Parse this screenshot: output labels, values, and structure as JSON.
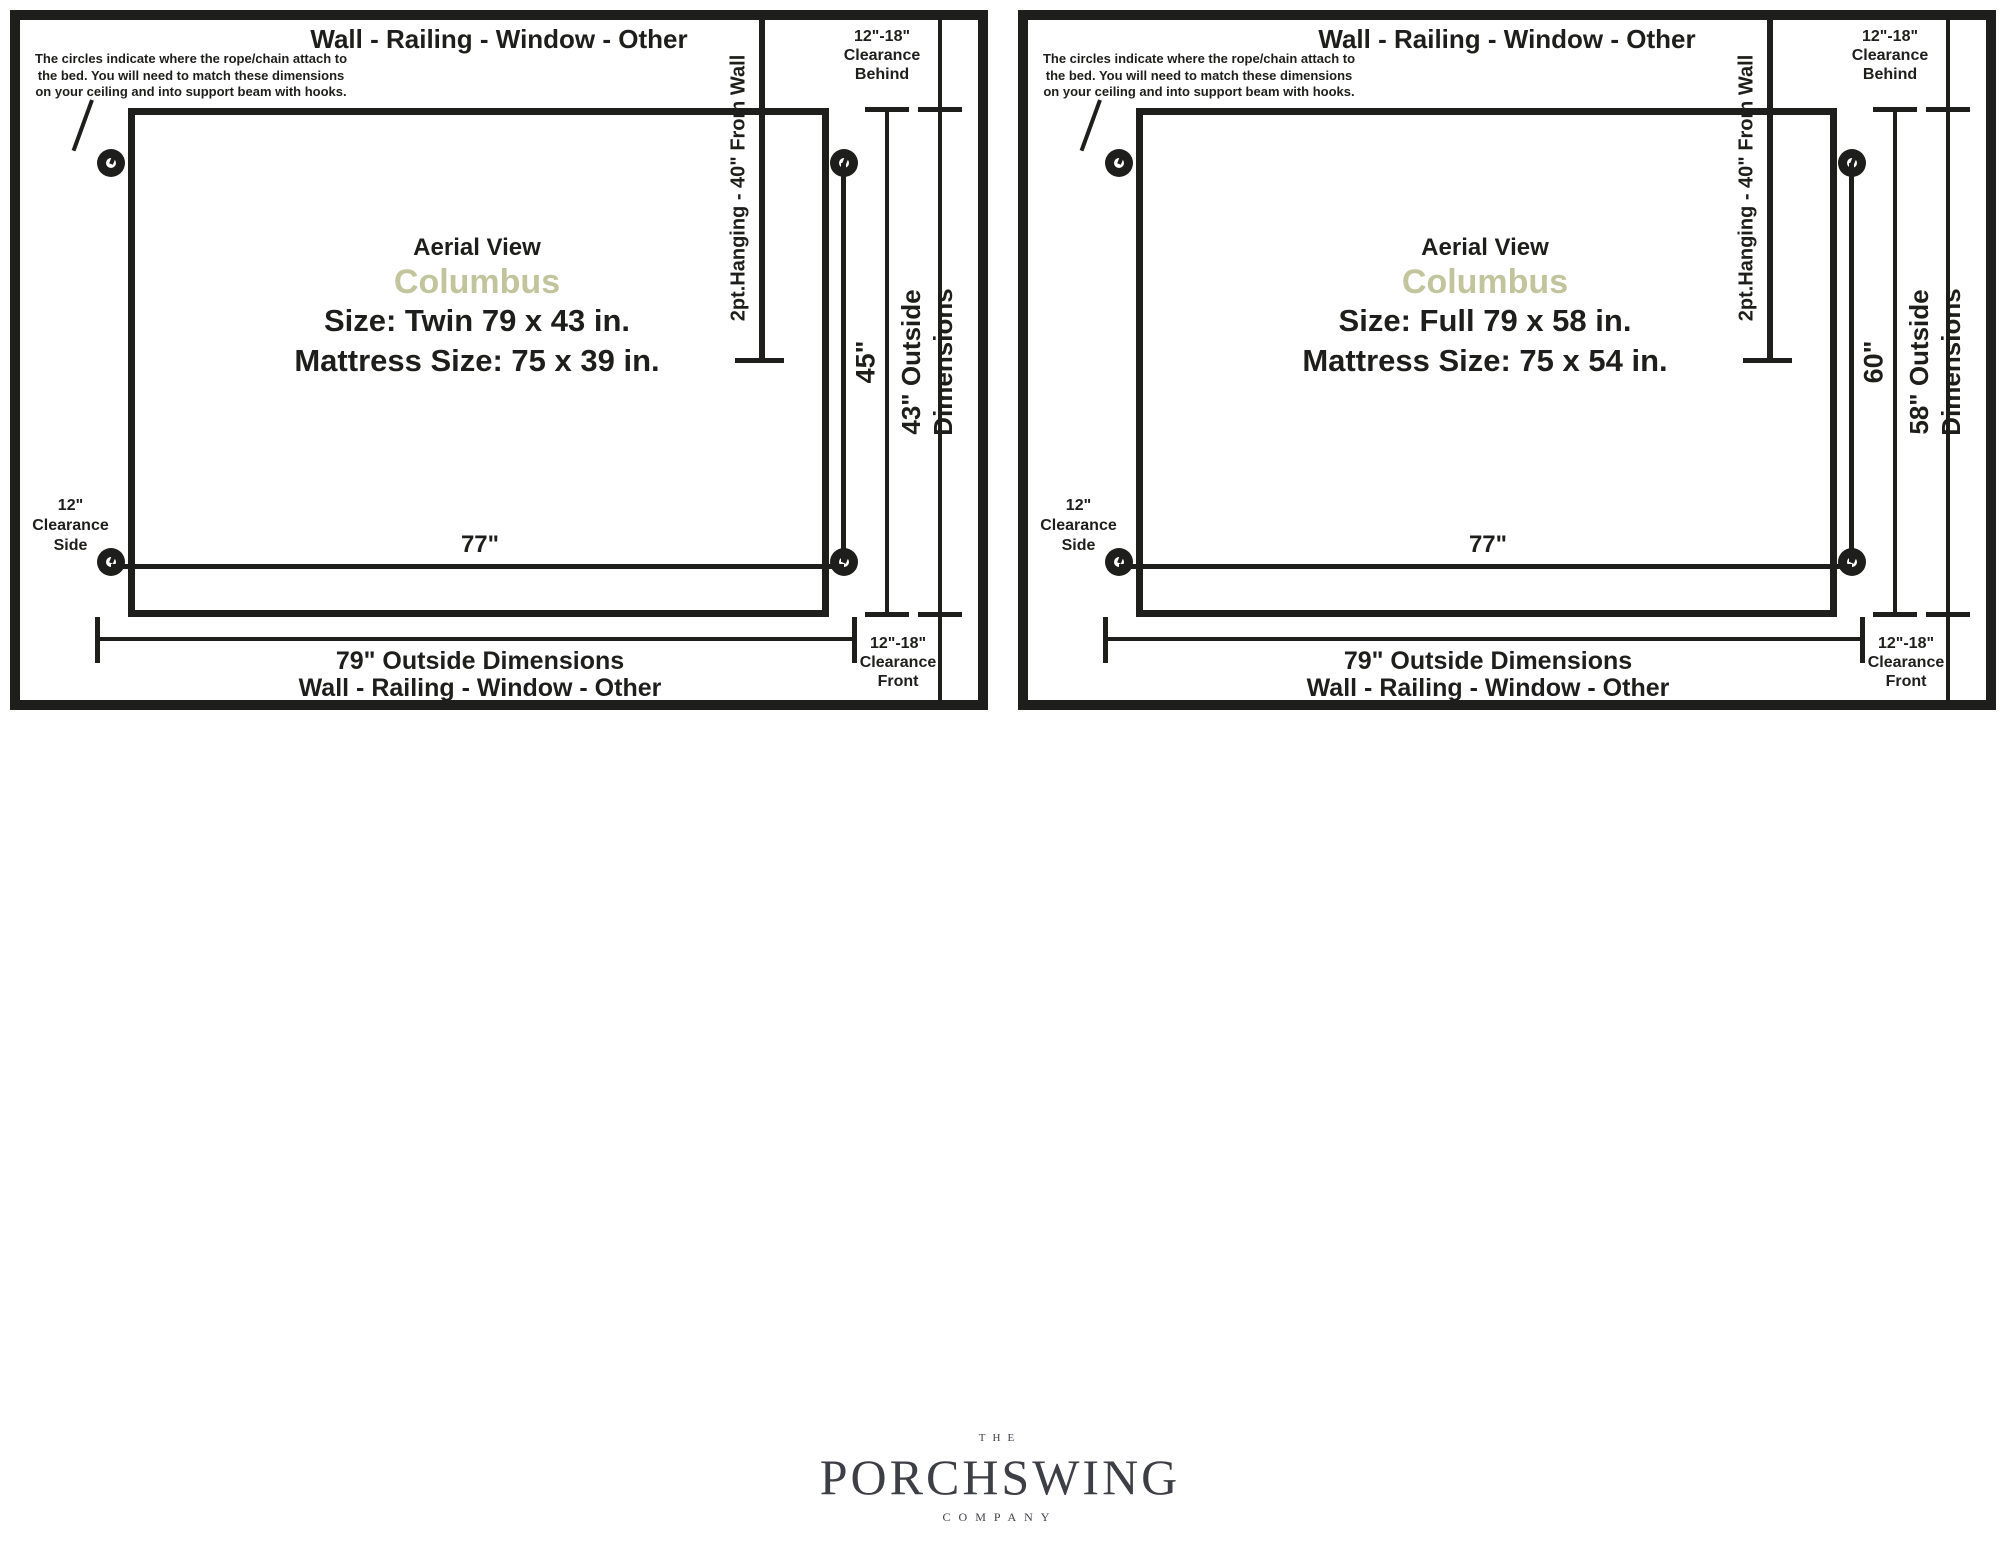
{
  "colors": {
    "ink": "#1e1e1c",
    "model_accent": "#c2c49c",
    "logo": "#3e3e46"
  },
  "diagrams": [
    {
      "top_label": "Wall - Railing - Window - Other",
      "note_lines": [
        "The circles indicate where the rope/chain attach to",
        "the bed. You will need to match these dimensions",
        "on your ceiling and into support beam with hooks."
      ],
      "hanging_label": "2pt.Hanging - 40\" From Wall",
      "clearance_behind": [
        "12\"-18\"",
        "Clearance",
        "Behind"
      ],
      "clearance_side": [
        "12\"",
        "Clearance",
        "Side"
      ],
      "clearance_front": [
        "12\"-18\"",
        "Clearance",
        "Front"
      ],
      "view_label": "Aerial View",
      "model_name": "Columbus",
      "size_line": "Size: Twin 79 x 43 in.",
      "mattress_line": "Mattress Size: 75 x 39 in.",
      "attach_width": "77\"",
      "attach_depth": "45\"",
      "outside_depth_lines": [
        "43\" Outside",
        "Dimensions"
      ],
      "outside_width": "79\" Outside Dimensions",
      "bottom_label": "Wall - Railing - Window - Other"
    },
    {
      "top_label": "Wall - Railing - Window - Other",
      "note_lines": [
        "The circles indicate where the rope/chain attach to",
        "the bed. You will need to match these dimensions",
        "on your ceiling and into support beam with hooks."
      ],
      "hanging_label": "2pt.Hanging - 40\" From Wall",
      "clearance_behind": [
        "12\"-18\"",
        "Clearance",
        "Behind"
      ],
      "clearance_side": [
        "12\"",
        "Clearance",
        "Side"
      ],
      "clearance_front": [
        "12\"-18\"",
        "Clearance",
        "Front"
      ],
      "view_label": "Aerial View",
      "model_name": "Columbus",
      "size_line": "Size: Full 79 x 58 in.",
      "mattress_line": "Mattress Size: 75 x 54 in.",
      "attach_width": "77\"",
      "attach_depth": "60\"",
      "outside_depth_lines": [
        "58\" Outside",
        "Dimensions"
      ],
      "outside_width": "79\" Outside Dimensions",
      "bottom_label": "Wall - Railing - Window - Other"
    }
  ],
  "logo": {
    "the": "THE",
    "name": "PORCHSWING",
    "company": "COMPANY"
  }
}
